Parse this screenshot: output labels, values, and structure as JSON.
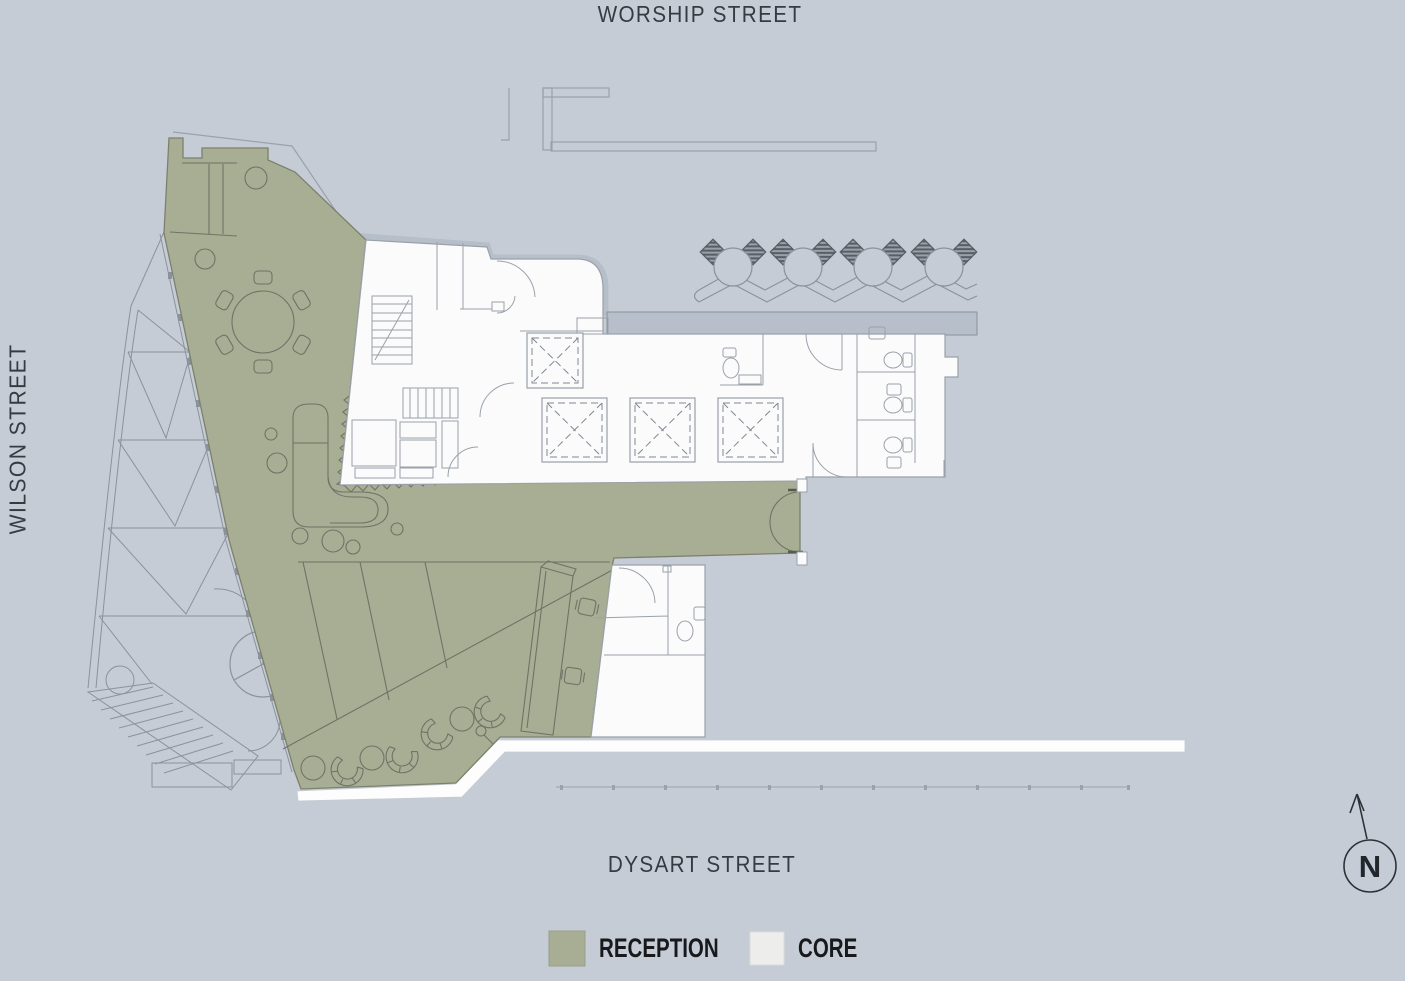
{
  "streets": {
    "top": "WORSHIP STREET",
    "left": "WILSON STREET",
    "bottom": "DYSART STREET"
  },
  "legend": {
    "items": [
      {
        "label": "RECEPTION",
        "color": "#a8ae94"
      },
      {
        "label": "CORE",
        "color": "#ededeb"
      }
    ]
  },
  "compass": {
    "label": "N",
    "icon": "north-arrow-icon"
  },
  "plan": {
    "colors": {
      "background": "#c5ccd6",
      "reception": "#a8ae94",
      "reception_outline": "#7c816c",
      "core": "#fbfbfc",
      "core_outline": "#9aa1aa",
      "terrace": "#b6bfca",
      "linework": "#8b929b"
    }
  }
}
